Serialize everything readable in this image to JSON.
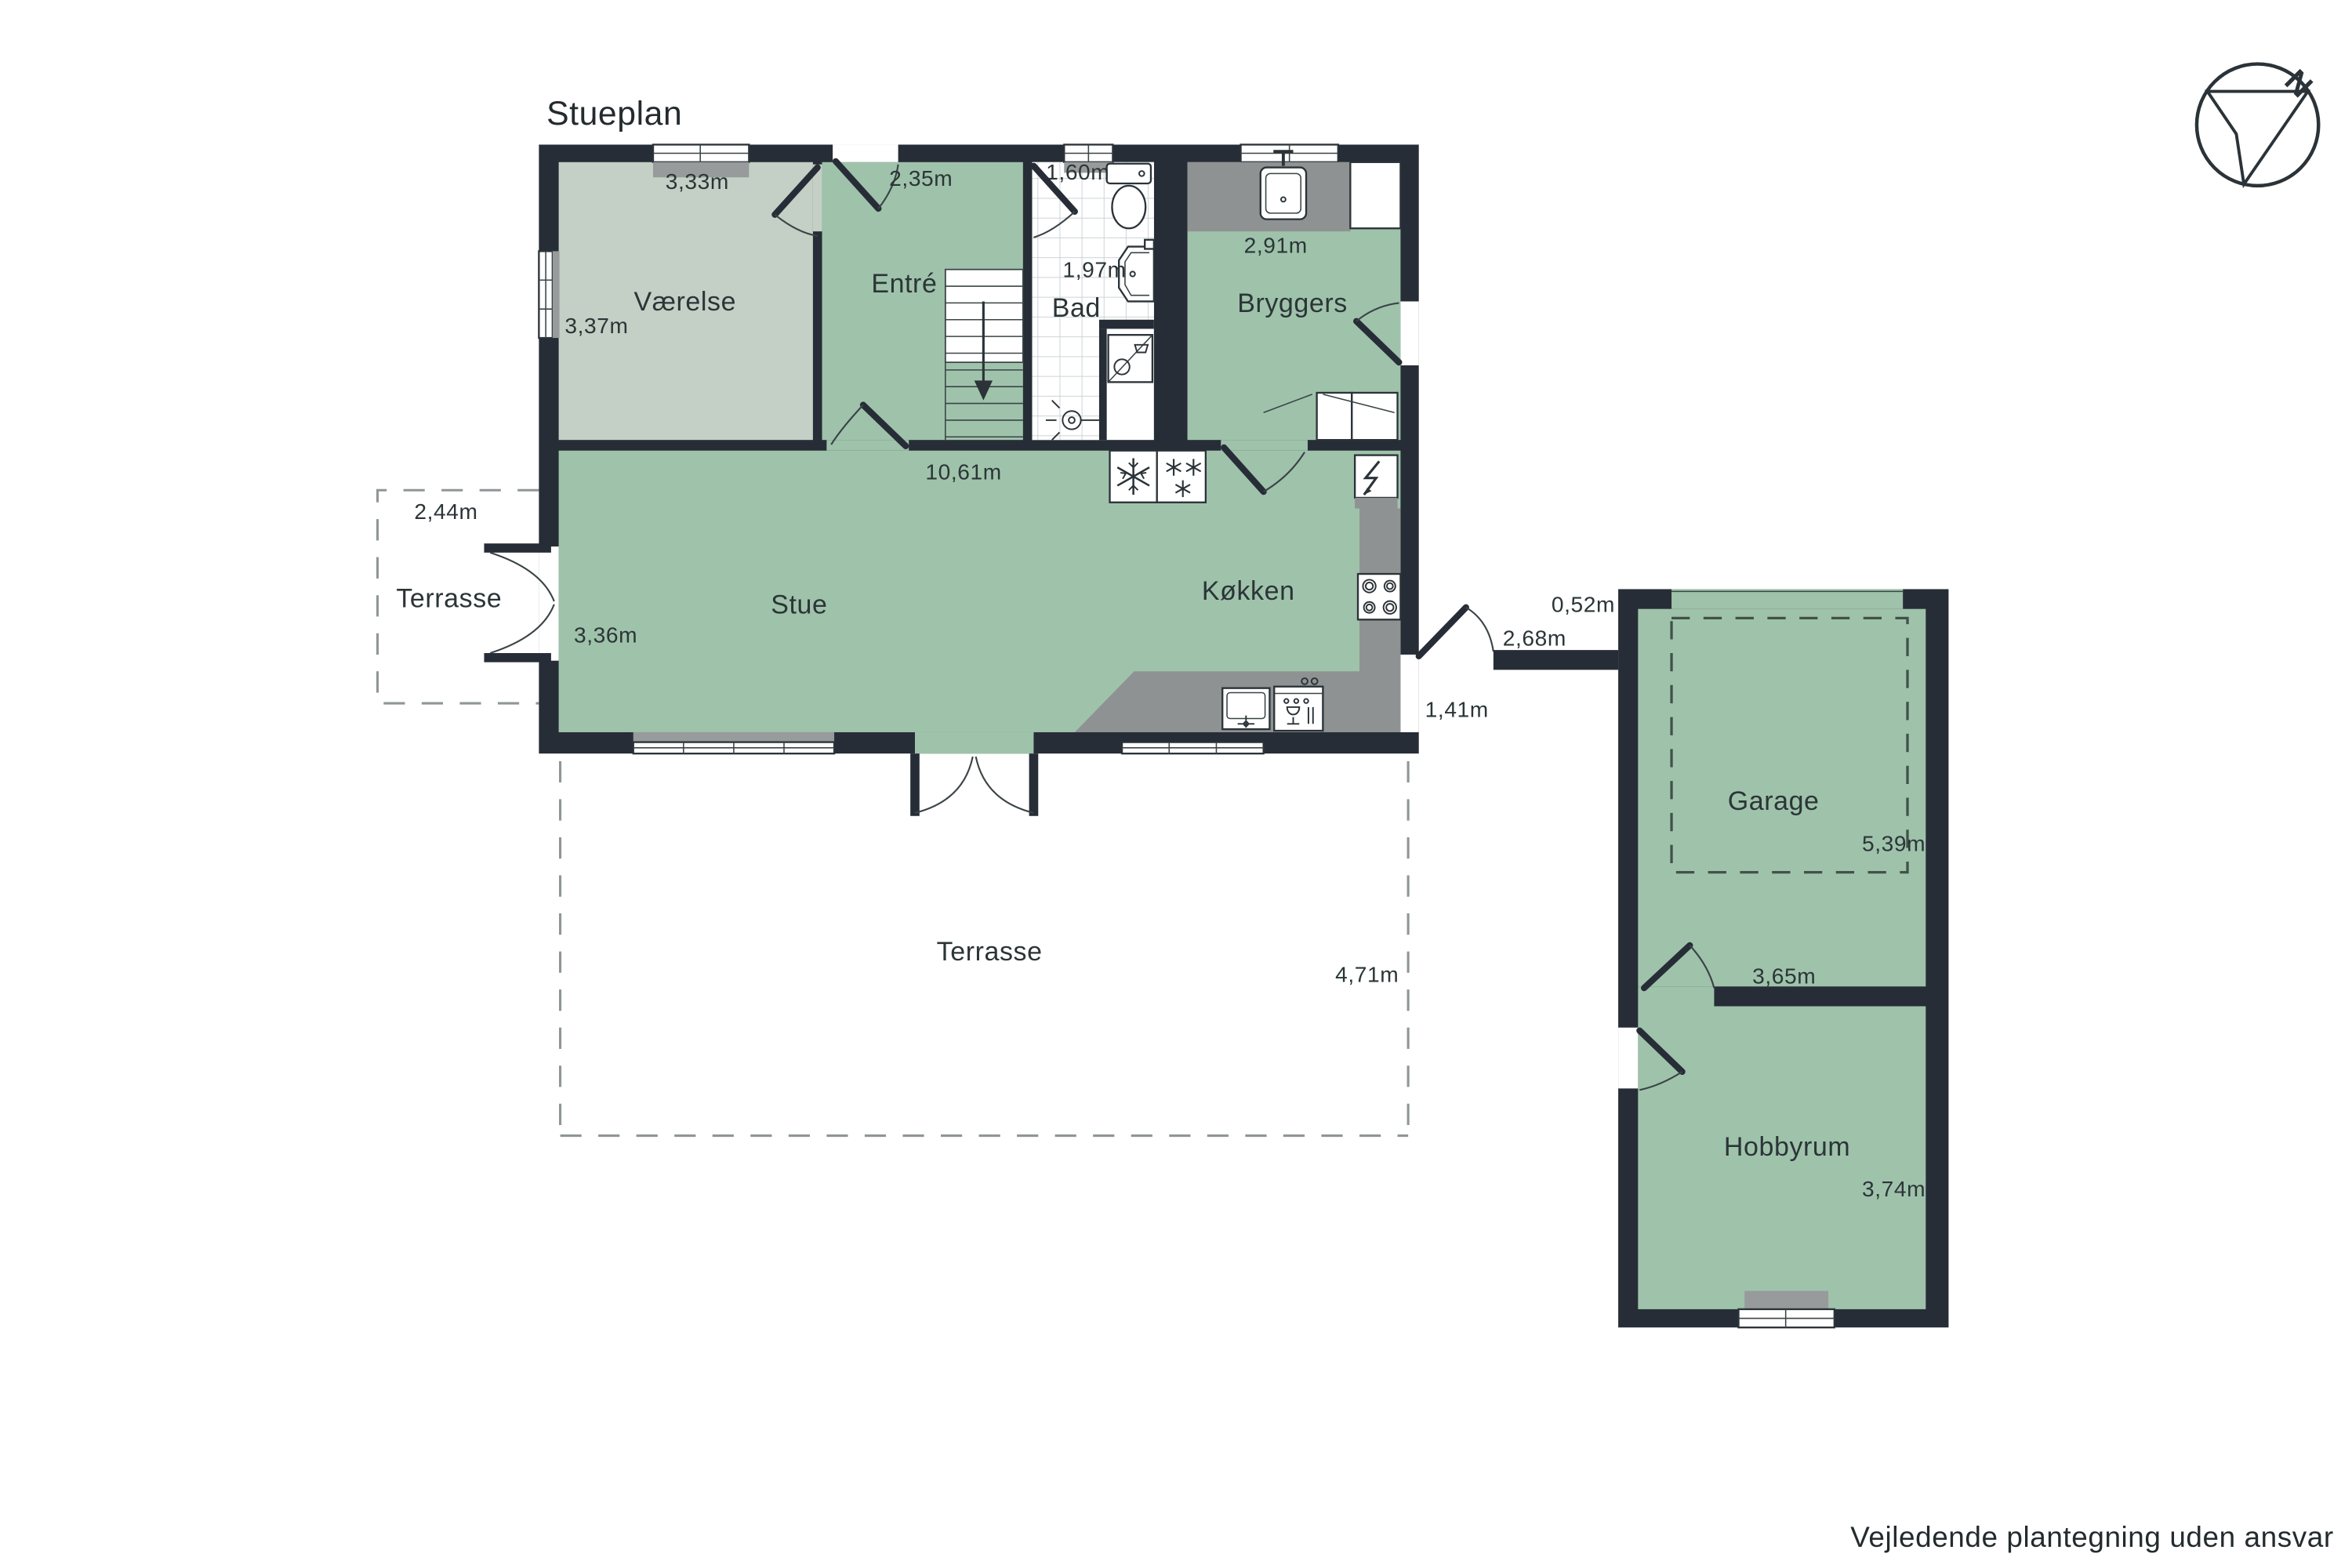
{
  "title": "Stueplan",
  "disclaimer": "Vejledende plantegning uden ansvar",
  "compass": {
    "north": "N"
  },
  "colors": {
    "wall": "#272d36",
    "room_green": "#9fc2ab",
    "vaerelse_green": "#c4cfc5",
    "counter_gray": "#8f9292",
    "sill_gray": "#979b9b",
    "tile_line": "#ccd4d6",
    "text": "#2b3537"
  },
  "rooms": [
    {
      "id": "vaerelse",
      "label": "Værelse",
      "measurements": [
        "3,33m",
        "3,37m"
      ]
    },
    {
      "id": "entre",
      "label": "Entré",
      "measurements": [
        "2,35m"
      ]
    },
    {
      "id": "bad",
      "label": "Bad",
      "measurements": [
        "1,60m",
        "1,97m"
      ]
    },
    {
      "id": "bryggers",
      "label": "Bryggers",
      "measurements": [
        "2,91m"
      ]
    },
    {
      "id": "stue",
      "label": "Stue",
      "measurements": [
        "3,36m"
      ]
    },
    {
      "id": "kokken",
      "label": "Køkken",
      "measurements": []
    },
    {
      "id": "terrasse-vest",
      "label": "Terrasse",
      "measurements": [
        "2,44m"
      ]
    },
    {
      "id": "terrasse-syd",
      "label": "Terrasse",
      "measurements": [
        "4,71m"
      ]
    },
    {
      "id": "garage",
      "label": "Garage",
      "measurements": [
        "5,39m",
        "3,65m"
      ]
    },
    {
      "id": "hobbyrum",
      "label": "Hobbyrum",
      "measurements": [
        "3,74m"
      ]
    }
  ],
  "shared_measurements": {
    "stue_kokken_width": "10,61m",
    "passage_top": "0,52m",
    "passage_wall": "2,68m",
    "entrance_side": "1,41m"
  }
}
